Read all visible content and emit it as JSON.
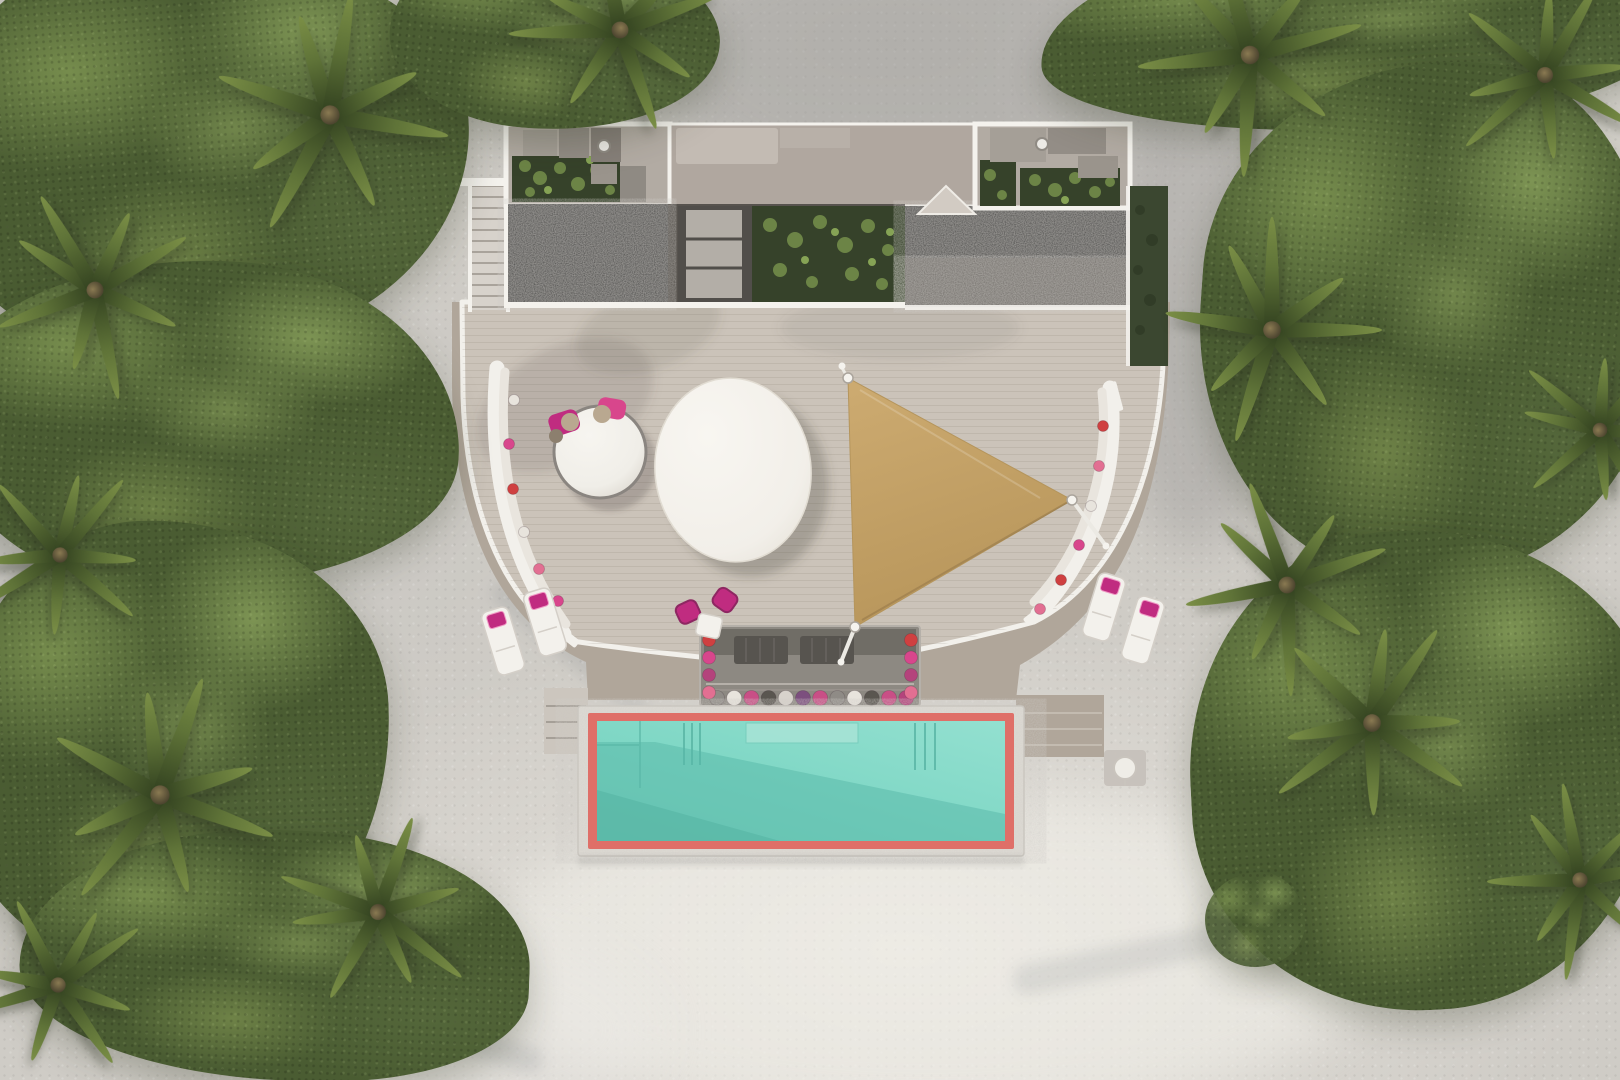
{
  "scene": {
    "type": "aerial-architectural-render",
    "setting": "tropical-beach-villa",
    "camera": "top-down",
    "description": "Top-down 3D render of a beach villa: curved timber deck with white-trimmed edge, two dark gravel roofs, rooftop gardens and skylight, right grass-roof strip, tan triangular shade sail, white oval pavilion roof, round daybed with magenta pillows, two curved benches with cushions, four white sun loungers with magenta cushions, a sunken lounge with pillow row, rectangular turquoise pool framed in coral red and white stone, all surrounded by dense palms, shrubs and white sand"
  },
  "colors": {
    "sand": "#cfccc6",
    "sand_bright": "#e9e6e0",
    "sand_shade": "#bdbbb7",
    "deck_upper": "#cbc3b9",
    "deck_lower": "#b0a69a",
    "deck_trim": "#f2f0eb",
    "stairs": "#d7d2cb",
    "stair_tread": "#a9a39b",
    "gravel": "#3e3e3d",
    "gravel_light": "#6f6b66",
    "wall_white": "#f4f2ed",
    "roof_band": "#b0a79f",
    "roof_light": "#c3bbb3",
    "module_floor": "#b2aba3",
    "garden": "#36422a",
    "plant": "#6c8446",
    "plant_light": "#86a355",
    "grass_roof": "#3b4730",
    "skylight": "#b3aea7",
    "skylight_frame": "#514e4a",
    "pool_rim": "#dedbd4",
    "pool_coral": "#df6f68",
    "pool_water": "#7fd7c5",
    "pool_water_light": "#93e0d0",
    "pool_water_shadow": "#58b7a7",
    "pool_step": "#58b4a4",
    "sail": "#c2a167",
    "sail_light": "#cdab71",
    "magenta": "#c02c80",
    "pink": "#e671a6",
    "red_cushion": "#cf4040",
    "furniture_white": "#f3f1ec",
    "daybed_rim": "#8a8580",
    "tan_pillow": "#b9a890",
    "lounge_base": "#8d8982",
    "lounge_mat": "#57544f",
    "veg_base": "#4a5c32",
    "veg_light": "#7e9552",
    "veg_lighter": "#8aa25c",
    "veg_deep": "#3c4d2b",
    "frond": "#5f7338"
  },
  "objects": {
    "pool": {
      "shape": "rectangle",
      "features": [
        "coral-red inner frame",
        "white stone rim",
        "submerged bench",
        "corner steps",
        "diagonal deck shadow on water"
      ]
    },
    "shade_sail": {
      "shape": "triangle",
      "anchors": 3
    },
    "sun_loungers": {
      "count": 4,
      "cushion": "magenta"
    },
    "curved_benches": {
      "count": 2
    },
    "round_daybed": {
      "count": 1
    },
    "oval_pavilion_roof": {
      "count": 1
    },
    "sunken_lounge": {
      "count": 1
    },
    "gravel_roofs": {
      "count": 2
    },
    "roof_gardens": {
      "count": 3
    },
    "grass_roof_strip": {
      "count": 1
    },
    "outdoor_showers": {
      "count": 2
    },
    "staircase": {
      "count": 1
    },
    "palm_trees": {
      "count": 14
    }
  },
  "pillows": {
    "sunken_row": [
      "#8f8b86",
      "#e8e4dd",
      "#c94f86",
      "#5a5650",
      "#d8d3cc",
      "#7c4f7e",
      "#c94f86",
      "#8f8b86",
      "#e8e4dd",
      "#5a5650",
      "#c94f86",
      "#b4437c"
    ],
    "sunken_sides": [
      "#cf4040",
      "#d8468c",
      "#b4437c",
      "#e26f92"
    ],
    "bench_left": [
      "#e8e4dd",
      "#d8468c",
      "#cf4040",
      "#e8e4dd",
      "#e26f92",
      "#d8468c"
    ],
    "bench_right": [
      "#cf4040",
      "#e26f92",
      "#e8e4dd",
      "#d8468c",
      "#cf4040",
      "#e26f92"
    ],
    "daybed": [
      "#c02c80",
      "#d8468c",
      "#b9a890",
      "#b9a890"
    ]
  }
}
